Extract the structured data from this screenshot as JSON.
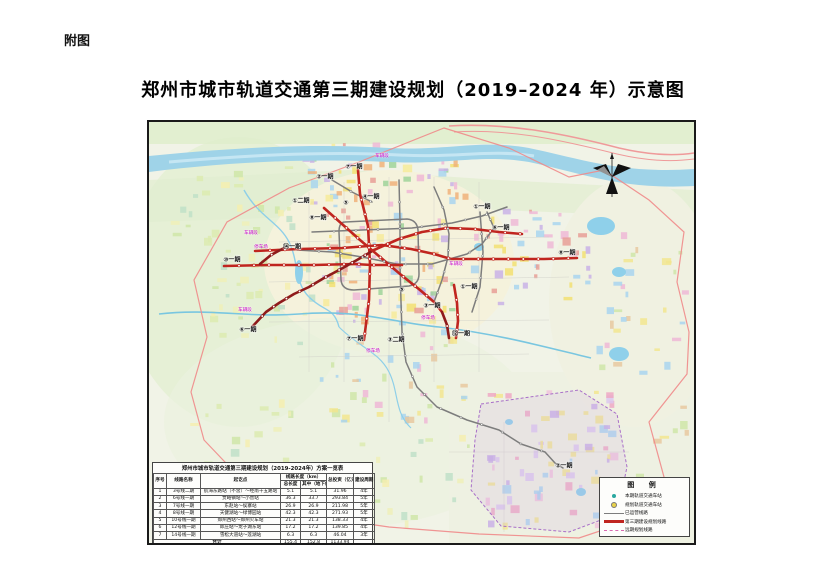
{
  "page": {
    "figure_label": "附图",
    "title": "郑州市城市轨道交通第三期建设规划（2019–2024 年）示意图"
  },
  "table": {
    "title": "郑州市城市轨道交通第三期建设规划（2019-2024年）方案一览表",
    "headers": {
      "index": "序号",
      "name": "线路名称",
      "termini": "起讫点",
      "length_group": "线路长度（km）",
      "length_total": "总长度",
      "length_underground": "其中（地下线）",
      "investment": "总投资（亿元）",
      "period": "建设周期"
    },
    "rows": [
      [
        "1",
        "3号线二期",
        "航海东路站（不含）～经南十五路站",
        "5.1",
        "5.1",
        "31.96",
        "4年"
      ],
      [
        "2",
        "6号线一期",
        "贾峪镇站～小营站",
        "36.3",
        "33.7",
        "293.84",
        "5年"
      ],
      [
        "3",
        "7号线一期",
        "东赵站～侯寨站",
        "26.9",
        "26.9",
        "211.98",
        "5年"
      ],
      [
        "4",
        "8号线一期",
        "天健湖站～绿博园站",
        "42.3",
        "42.3",
        "271.93",
        "5年"
      ],
      [
        "5",
        "10号线一期",
        "郑州西站～郑州火车站",
        "21.3",
        "21.3",
        "138.33",
        "4年"
      ],
      [
        "6",
        "12号线一期",
        "郎庄站～龙子湖东站",
        "17.2",
        "17.2",
        "139.85",
        "4年"
      ],
      [
        "7",
        "14号线一期",
        "雪松大道站～莲湖站",
        "6.3",
        "6.3",
        "46.04",
        "3年"
      ],
      [
        "",
        "合计",
        "",
        "155.4",
        "152.8",
        "1133.94",
        ""
      ]
    ]
  },
  "legend": {
    "title": "图 例",
    "items": [
      {
        "label": "本期轨道交通车站",
        "swatch": "dot-teal"
      },
      {
        "label": "规划轨道交通车站",
        "swatch": "dot-yellow"
      },
      {
        "label": "已运营线路",
        "swatch": "line-gray"
      },
      {
        "label": "第三期建设规划线路",
        "swatch": "line-red"
      },
      {
        "label": "远期规划线路",
        "swatch": "line-magenta"
      }
    ]
  },
  "map_labels": [
    {
      "text": "⑦一期",
      "x": 205,
      "y": 44
    },
    {
      "text": "②一期",
      "x": 176,
      "y": 54
    },
    {
      "text": "①二期",
      "x": 152,
      "y": 78
    },
    {
      "text": "④一期",
      "x": 222,
      "y": 74
    },
    {
      "text": "⑤",
      "x": 197,
      "y": 81
    },
    {
      "text": "⑧一期",
      "x": 169,
      "y": 95
    },
    {
      "text": "①一期",
      "x": 333,
      "y": 84
    },
    {
      "text": "⑥一期",
      "x": 352,
      "y": 105
    },
    {
      "text": "⑧一期",
      "x": 418,
      "y": 130
    },
    {
      "text": "⑩一期",
      "x": 83,
      "y": 137
    },
    {
      "text": "⑭一期",
      "x": 143,
      "y": 124
    },
    {
      "text": "⑤",
      "x": 253,
      "y": 168
    },
    {
      "text": "③一期",
      "x": 283,
      "y": 183
    },
    {
      "text": "①一期",
      "x": 320,
      "y": 164
    },
    {
      "text": "⑫一期",
      "x": 312,
      "y": 211
    },
    {
      "text": "⑥一期",
      "x": 99,
      "y": 207
    },
    {
      "text": "⑦一期",
      "x": 206,
      "y": 216
    },
    {
      "text": "③二期",
      "x": 247,
      "y": 217
    },
    {
      "text": "②一期",
      "x": 415,
      "y": 343
    }
  ],
  "depot_labels": [
    {
      "text": "车辆段",
      "x": 233,
      "y": 34
    },
    {
      "text": "车辆段",
      "x": 102,
      "y": 111
    },
    {
      "text": "停车场",
      "x": 112,
      "y": 125
    },
    {
      "text": "车辆段",
      "x": 96,
      "y": 188
    },
    {
      "text": "停车场",
      "x": 224,
      "y": 229
    },
    {
      "text": "车辆段",
      "x": 307,
      "y": 142
    },
    {
      "text": "停车场",
      "x": 279,
      "y": 196
    }
  ],
  "colors": {
    "line_new": "#c0251f",
    "line_new_dark": "#8f1b1b",
    "line_existing": "#7d7d7d",
    "city_boundary": "#ef8a8a",
    "airport_boundary": "#a86ec8",
    "water": "#9fd3e8",
    "depot_text": "#c400c4",
    "legend_dot_teal": "#2aa8a0",
    "legend_dot_yellow": "#e8d24a",
    "legend_line_magenta": "#d86ab0"
  }
}
